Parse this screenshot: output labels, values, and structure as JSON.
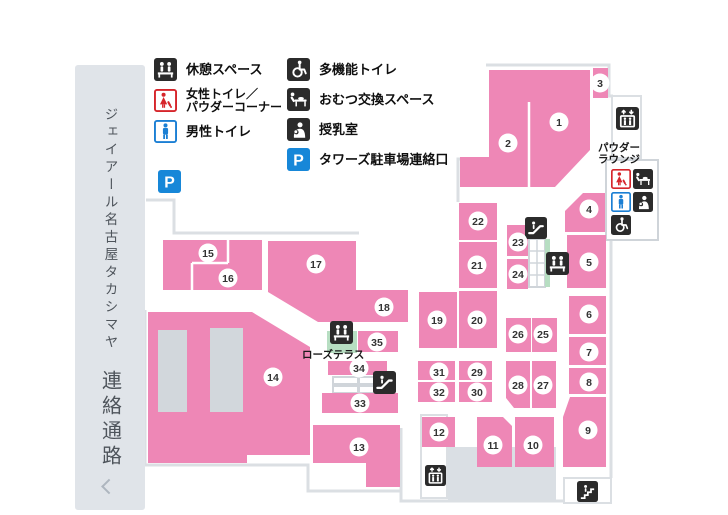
{
  "sidebar": {
    "title": "ジェイアール名古屋タカシマヤ",
    "subtitle": "連絡通路"
  },
  "legend": {
    "left": [
      {
        "icon": "rest",
        "lines": [
          "休憩スペース"
        ]
      },
      {
        "icon": "women",
        "lines": [
          "女性トイレ／",
          "パウダーコーナー"
        ]
      },
      {
        "icon": "men",
        "lines": [
          "男性トイレ"
        ]
      }
    ],
    "right": [
      {
        "icon": "wheelchair",
        "lines": [
          "多機能トイレ"
        ]
      },
      {
        "icon": "diaper",
        "lines": [
          "おむつ交換スペース"
        ]
      },
      {
        "icon": "nursing",
        "lines": [
          "授乳室"
        ]
      },
      {
        "icon": "parking",
        "lines": [
          "タワーズ駐車場連絡口"
        ]
      }
    ]
  },
  "map": {
    "colors": {
      "block": "#ee87b6",
      "wall": "#dbdfe3",
      "floor": "#dadfe4",
      "green": "#b7dec2",
      "slot": "#d2d7dc",
      "circle_fill": "#ffffff",
      "circle_text": "#333333",
      "box_stroke": "#cfd4d9",
      "detail": "#d0d5da"
    },
    "walls": [
      "146,200 174,200 174,233 359,233",
      "489,159 458,159 458,202",
      "486,65 609,65 609,96 613,96",
      "611,241 611,478",
      "611,501 401,501 401,428",
      "145,310 145,465 308,465 308,491 401,491"
    ],
    "white_lines": [
      [
        529,
        102,
        529,
        187
      ],
      [
        228,
        240,
        228,
        263
      ],
      [
        192,
        263,
        228,
        263
      ],
      [
        192,
        263,
        192,
        290
      ]
    ],
    "detail_lines": [
      [
        537,
        239,
        537,
        287
      ],
      [
        529,
        251,
        545,
        251
      ],
      [
        529,
        263,
        545,
        263
      ],
      [
        529,
        275,
        545,
        275
      ]
    ],
    "structures": [
      {
        "name": "floor-area",
        "x": 448,
        "y": 447,
        "w": 108,
        "h": 53,
        "fill": "floor"
      },
      {
        "name": "elevator-bay-top",
        "x": 612,
        "y": 96,
        "w": 29,
        "h": 62,
        "fill": "#ffffff",
        "stroke": "wall"
      },
      {
        "name": "powder-lounge-box",
        "x": 606,
        "y": 160,
        "w": 52,
        "h": 80,
        "fill": "#ffffff",
        "stroke": "box_stroke"
      },
      {
        "name": "elevator-bay-bottom",
        "x": 421,
        "y": 415,
        "w": 26,
        "h": 83,
        "fill": "#ffffff",
        "stroke": "wall"
      },
      {
        "name": "stairs-bay",
        "x": 564,
        "y": 478,
        "w": 47,
        "h": 25,
        "fill": "#ffffff",
        "stroke": "wall"
      },
      {
        "name": "escalator-shaft",
        "x": 529,
        "y": 239,
        "w": 16,
        "h": 48,
        "fill": "#ffffff",
        "stroke": "box_stroke"
      },
      {
        "name": "escalator-green",
        "x": 545,
        "y": 239,
        "w": 5,
        "h": 48,
        "fill": "green"
      },
      {
        "name": "rose-terrace-area",
        "x": 327,
        "y": 331,
        "w": 30,
        "h": 22,
        "fill": "green"
      },
      {
        "name": "stair-tread",
        "x": 333,
        "y": 377,
        "w": 25,
        "h": 7,
        "fill": "#ffffff",
        "stroke": "detail"
      },
      {
        "name": "stair-tread",
        "x": 359,
        "y": 377,
        "w": 27,
        "h": 7,
        "fill": "#ffffff",
        "stroke": "detail"
      },
      {
        "name": "stair-tread",
        "x": 333,
        "y": 386,
        "w": 25,
        "h": 7,
        "fill": "#ffffff",
        "stroke": "detail"
      },
      {
        "name": "stair-tread",
        "x": 359,
        "y": 386,
        "w": 27,
        "h": 7,
        "fill": "#ffffff",
        "stroke": "detail"
      }
    ],
    "blocks": [
      {
        "n": "1",
        "poly": "489,70 590,70 590,150 555,187 529,187 529,102 489,102",
        "c": [
          559,
          122
        ]
      },
      {
        "n": "2",
        "poly": "489,102 529,102 529,187 460,187 460,157 489,157",
        "c": [
          508,
          143
        ]
      },
      {
        "n": "3",
        "rect": [
          593,
          68,
          15,
          30
        ],
        "c": [
          600,
          83
        ]
      },
      {
        "n": "4",
        "poly": "583,193 605,193 605,232 565,232 565,211",
        "c": [
          589,
          209
        ]
      },
      {
        "n": "5",
        "rect": [
          567,
          235,
          39,
          53
        ],
        "c": [
          589,
          262
        ]
      },
      {
        "n": "6",
        "rect": [
          569,
          296,
          37,
          38
        ],
        "c": [
          589,
          314
        ]
      },
      {
        "n": "7",
        "rect": [
          569,
          337,
          37,
          28
        ],
        "c": [
          589,
          352
        ]
      },
      {
        "n": "8",
        "rect": [
          569,
          368,
          37,
          26
        ],
        "c": [
          589,
          382
        ]
      },
      {
        "n": "9",
        "poly": "570,397 606,397 606,467 563,467 563,417",
        "c": [
          588,
          430
        ]
      },
      {
        "n": "10",
        "rect": [
          515,
          417,
          39,
          50
        ],
        "c": [
          533,
          445
        ]
      },
      {
        "n": "11",
        "poly": "477,417 503,417 512,426 512,467 477,467",
        "c": [
          493,
          445
        ]
      },
      {
        "n": "12",
        "rect": [
          422,
          417,
          33,
          30
        ],
        "c": [
          439,
          432
        ]
      },
      {
        "n": "13",
        "poly": "313,425 400,425 400,487 366,487 366,463 313,463",
        "c": [
          359,
          447
        ]
      },
      {
        "n": "14",
        "poly": "148,312 252,312 310,347 310,455 247,455 247,463 148,463",
        "c": [
          273,
          377
        ]
      },
      {
        "n": "15",
        "rect": [
          163,
          240,
          99,
          50
        ],
        "c": [
          208,
          253
        ]
      },
      {
        "n": "16",
        "c": [
          228,
          278
        ]
      },
      {
        "n": "17",
        "poly": "268,241 356,241 356,322 318,322 268,292",
        "c": [
          316,
          264
        ]
      },
      {
        "n": "18",
        "rect": [
          356,
          290,
          52,
          32
        ],
        "c": [
          384,
          307
        ]
      },
      {
        "n": "19",
        "rect": [
          419,
          292,
          38,
          56
        ],
        "c": [
          437,
          320
        ]
      },
      {
        "n": "20",
        "rect": [
          459,
          291,
          38,
          57
        ],
        "c": [
          477,
          320
        ]
      },
      {
        "n": "21",
        "rect": [
          459,
          242,
          38,
          46
        ],
        "c": [
          477,
          265
        ]
      },
      {
        "n": "22",
        "rect": [
          459,
          203,
          38,
          37
        ],
        "c": [
          478,
          221
        ]
      },
      {
        "n": "23",
        "rect": [
          507,
          225,
          21,
          31
        ],
        "c": [
          518,
          242
        ]
      },
      {
        "n": "24",
        "rect": [
          507,
          259,
          21,
          30
        ],
        "c": [
          518,
          274
        ]
      },
      {
        "n": "25",
        "rect": [
          532,
          318,
          25,
          34
        ],
        "c": [
          543,
          334
        ]
      },
      {
        "n": "26",
        "rect": [
          506,
          318,
          25,
          34
        ],
        "c": [
          518,
          334
        ]
      },
      {
        "n": "27",
        "rect": [
          532,
          361,
          24,
          47
        ],
        "c": [
          543,
          385
        ]
      },
      {
        "n": "28",
        "poly": "506,361 530,361 530,408 514,408 506,398",
        "c": [
          518,
          385
        ]
      },
      {
        "n": "29",
        "rect": [
          459,
          361,
          33,
          19
        ],
        "c": [
          477,
          372
        ]
      },
      {
        "n": "30",
        "rect": [
          459,
          382,
          33,
          20
        ],
        "c": [
          477,
          392
        ]
      },
      {
        "n": "31",
        "rect": [
          418,
          361,
          37,
          19
        ],
        "c": [
          439,
          372
        ]
      },
      {
        "n": "32",
        "rect": [
          418,
          382,
          37,
          20
        ],
        "c": [
          439,
          392
        ]
      },
      {
        "n": "33",
        "rect": [
          322,
          393,
          76,
          20
        ],
        "c": [
          360,
          403
        ]
      },
      {
        "n": "34",
        "rect": [
          328,
          361,
          59,
          14
        ],
        "c": [
          359,
          368
        ]
      },
      {
        "n": "35",
        "rect": [
          358,
          331,
          40,
          21
        ],
        "c": [
          377,
          342
        ]
      }
    ],
    "slots": [
      [
        158,
        330,
        29,
        82
      ],
      [
        210,
        328,
        33,
        84
      ]
    ],
    "icons": [
      {
        "t": "parking",
        "x": 158,
        "y": 170,
        "s": 23
      },
      {
        "t": "elevator",
        "x": 616,
        "y": 107,
        "s": 23
      },
      {
        "t": "escalator",
        "x": 525,
        "y": 217,
        "s": 22
      },
      {
        "t": "rest",
        "x": 546,
        "y": 252,
        "s": 23
      },
      {
        "t": "rest",
        "x": 330,
        "y": 321,
        "s": 23
      },
      {
        "t": "escalator",
        "x": 373,
        "y": 371,
        "s": 23
      },
      {
        "t": "elevator",
        "x": 425,
        "y": 465,
        "s": 21
      },
      {
        "t": "stairs",
        "x": 577,
        "y": 481,
        "s": 21
      },
      {
        "t": "women",
        "x": 611,
        "y": 169,
        "s": 20
      },
      {
        "t": "diaper",
        "x": 633,
        "y": 169,
        "s": 20
      },
      {
        "t": "men",
        "x": 611,
        "y": 192,
        "s": 20
      },
      {
        "t": "nursing",
        "x": 633,
        "y": 192,
        "s": 20
      },
      {
        "t": "wheelchair",
        "x": 611,
        "y": 215,
        "s": 20
      }
    ],
    "labels": [
      {
        "name": "powder-lounge-label",
        "lines": [
          "パウダー",
          "ラウンジ"
        ],
        "x": 640,
        "y": 151,
        "anchor": "end",
        "size": 10.5
      },
      {
        "name": "rose-terrace-label",
        "lines": [
          "ローズテラス"
        ],
        "x": 302,
        "y": 358,
        "anchor": "start",
        "size": 10.5
      }
    ]
  }
}
